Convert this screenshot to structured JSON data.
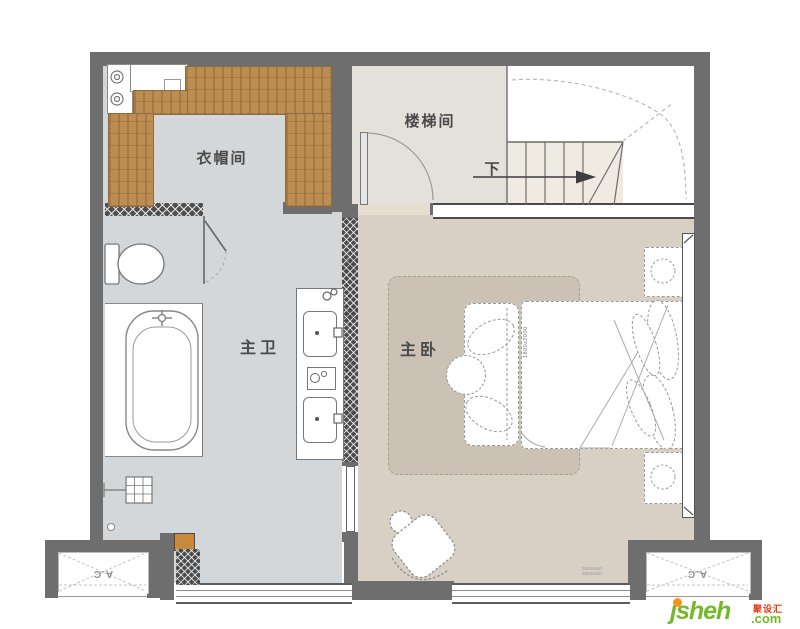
{
  "plan": {
    "type": "floor-plan",
    "rooms": {
      "cloakroom": {
        "label": "衣帽间"
      },
      "stairwell": {
        "label": "楼梯间"
      },
      "master_bath": {
        "label": "主卫"
      },
      "master_bedroom": {
        "label": "主卧"
      }
    },
    "stairs": {
      "direction_label": "下"
    },
    "ac": {
      "left_label": "A.C",
      "right_label": "A.C"
    },
    "annotations": {
      "bed_size": "1800x2000",
      "floor_note_line1": "2600x600",
      "floor_note_line2": "2600x600"
    }
  },
  "watermark": {
    "brand": "jsheh",
    "suffix": ".com",
    "cjk_name": "聚设汇"
  },
  "colors": {
    "wall": "#6E6E6E",
    "bath_floor": "#D4D7D9",
    "hall_floor": "#E3E1D9",
    "bedroom_floor": "#D8D0C5",
    "rug": "#CBC2B5",
    "wardrobe": "#BC8E54",
    "logo_green": "#76B82A",
    "logo_orange": "#F7941D",
    "logo_red": "#E8380D"
  }
}
